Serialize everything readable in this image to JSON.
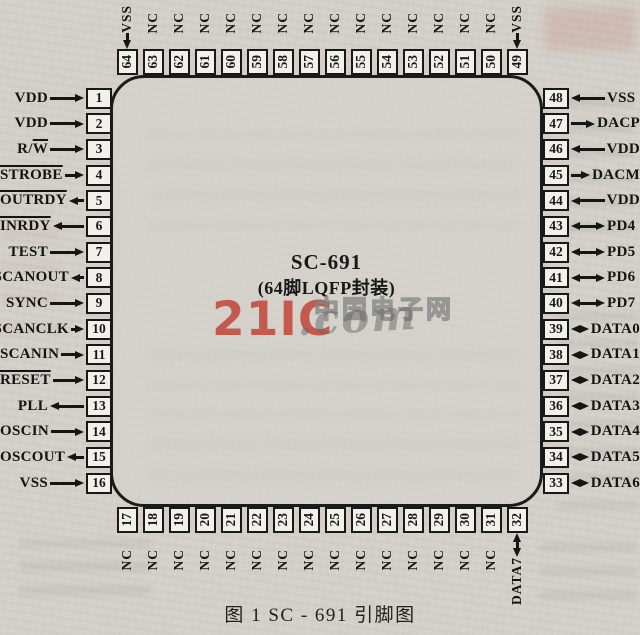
{
  "figure": {
    "chip_name": "SC-691",
    "package_label": "(64脚LQFP封装)",
    "caption": "图 1   SC - 691 引脚图",
    "watermark": {
      "logo": "21IC",
      "domain": ".com",
      "site_name": "中国电子网",
      "logo_color": "#c23e31"
    },
    "colors": {
      "paper": "#d3d0c9",
      "ink": "#181818",
      "pin_box_fill": "#f2f0ea"
    },
    "pins": {
      "left": [
        {
          "num": 1,
          "label": "VDD",
          "dir": "in"
        },
        {
          "num": 2,
          "label": "VDD",
          "dir": "in"
        },
        {
          "num": 3,
          "label": "R/W",
          "dir": "in",
          "overline": "W"
        },
        {
          "num": 4,
          "label": "STROBE",
          "dir": "in",
          "overline": "full"
        },
        {
          "num": 5,
          "label": "OUTRDY",
          "dir": "out",
          "overline": "full"
        },
        {
          "num": 6,
          "label": "INRDY",
          "dir": "out",
          "overline": "full"
        },
        {
          "num": 7,
          "label": "TEST",
          "dir": "in"
        },
        {
          "num": 8,
          "label": "SCANOUT",
          "dir": "out"
        },
        {
          "num": 9,
          "label": "SYNC",
          "dir": "in"
        },
        {
          "num": 10,
          "label": "SCANCLK",
          "dir": "in"
        },
        {
          "num": 11,
          "label": "SCANIN",
          "dir": "in"
        },
        {
          "num": 12,
          "label": "RESET",
          "dir": "in",
          "overline": "full"
        },
        {
          "num": 13,
          "label": "PLL",
          "dir": "out"
        },
        {
          "num": 14,
          "label": "OSCIN",
          "dir": "in"
        },
        {
          "num": 15,
          "label": "OSCOUT",
          "dir": "out"
        },
        {
          "num": 16,
          "label": "VSS",
          "dir": "in"
        }
      ],
      "right": [
        {
          "num": 48,
          "label": "VSS",
          "dir": "in"
        },
        {
          "num": 47,
          "label": "DACP",
          "dir": "out"
        },
        {
          "num": 46,
          "label": "VDD",
          "dir": "in"
        },
        {
          "num": 45,
          "label": "DACM",
          "dir": "out"
        },
        {
          "num": 44,
          "label": "VDD",
          "dir": "in"
        },
        {
          "num": 43,
          "label": "PD4",
          "dir": "bi"
        },
        {
          "num": 42,
          "label": "PD5",
          "dir": "bi"
        },
        {
          "num": 41,
          "label": "PD6",
          "dir": "bi"
        },
        {
          "num": 40,
          "label": "PD7",
          "dir": "bi"
        },
        {
          "num": 39,
          "label": "DATA0",
          "dir": "bi"
        },
        {
          "num": 38,
          "label": "DATA1",
          "dir": "bi"
        },
        {
          "num": 37,
          "label": "DATA2",
          "dir": "bi"
        },
        {
          "num": 36,
          "label": "DATA3",
          "dir": "bi"
        },
        {
          "num": 35,
          "label": "DATA4",
          "dir": "bi"
        },
        {
          "num": 34,
          "label": "DATA5",
          "dir": "bi"
        },
        {
          "num": 33,
          "label": "DATA6",
          "dir": "bi"
        }
      ],
      "top": [
        {
          "num": 64,
          "label": "VSS",
          "dir": "in"
        },
        {
          "num": 63,
          "label": "NC",
          "dir": "none"
        },
        {
          "num": 62,
          "label": "NC",
          "dir": "none"
        },
        {
          "num": 61,
          "label": "NC",
          "dir": "none"
        },
        {
          "num": 60,
          "label": "NC",
          "dir": "none"
        },
        {
          "num": 59,
          "label": "NC",
          "dir": "none"
        },
        {
          "num": 58,
          "label": "NC",
          "dir": "none"
        },
        {
          "num": 57,
          "label": "NC",
          "dir": "none"
        },
        {
          "num": 56,
          "label": "NC",
          "dir": "none"
        },
        {
          "num": 55,
          "label": "NC",
          "dir": "none"
        },
        {
          "num": 54,
          "label": "NC",
          "dir": "none"
        },
        {
          "num": 53,
          "label": "NC",
          "dir": "none"
        },
        {
          "num": 52,
          "label": "NC",
          "dir": "none"
        },
        {
          "num": 51,
          "label": "NC",
          "dir": "none"
        },
        {
          "num": 50,
          "label": "NC",
          "dir": "none"
        },
        {
          "num": 49,
          "label": "VSS",
          "dir": "in"
        }
      ],
      "bottom": [
        {
          "num": 17,
          "label": "NC",
          "dir": "none"
        },
        {
          "num": 18,
          "label": "NC",
          "dir": "none"
        },
        {
          "num": 19,
          "label": "NC",
          "dir": "none"
        },
        {
          "num": 20,
          "label": "NC",
          "dir": "none"
        },
        {
          "num": 21,
          "label": "NC",
          "dir": "none"
        },
        {
          "num": 22,
          "label": "NC",
          "dir": "none"
        },
        {
          "num": 23,
          "label": "NC",
          "dir": "none"
        },
        {
          "num": 24,
          "label": "NC",
          "dir": "none"
        },
        {
          "num": 25,
          "label": "NC",
          "dir": "none"
        },
        {
          "num": 26,
          "label": "NC",
          "dir": "none"
        },
        {
          "num": 27,
          "label": "NC",
          "dir": "none"
        },
        {
          "num": 28,
          "label": "NC",
          "dir": "none"
        },
        {
          "num": 29,
          "label": "NC",
          "dir": "none"
        },
        {
          "num": 30,
          "label": "NC",
          "dir": "none"
        },
        {
          "num": 31,
          "label": "NC",
          "dir": "none"
        },
        {
          "num": 32,
          "label": "DATA7",
          "dir": "bi"
        }
      ]
    }
  }
}
